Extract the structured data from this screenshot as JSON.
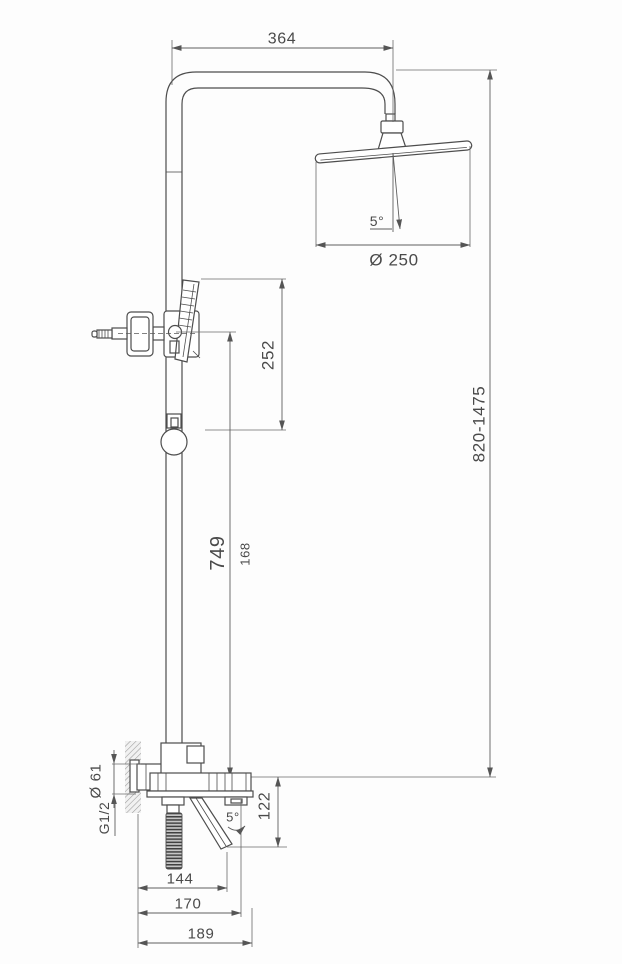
{
  "drawing": {
    "type": "technical-dimension-drawing",
    "subject": "shower column set with overhead shower, hand shower, wall mixer and tub spout",
    "units": "mm",
    "colors": {
      "line": "#4d4d4d",
      "dimension": "#5e5e5e",
      "text": "#4a4a4a",
      "hatch": "#9a9a9a",
      "background": "#fdfdfd"
    },
    "labels": {
      "arm_reach": "364",
      "head_angle": "5°",
      "head_diameter": "Ø 250",
      "height_range": "820-1475",
      "slide_section": "252",
      "riser_height": "749",
      "riser_section": "168",
      "spout_drop": "122",
      "spout_angle": "5°",
      "flange_diameter": "Ø 61",
      "thread_size": "G1/2",
      "reach_near": "144",
      "reach_mid": "170",
      "reach_far": "189"
    }
  }
}
